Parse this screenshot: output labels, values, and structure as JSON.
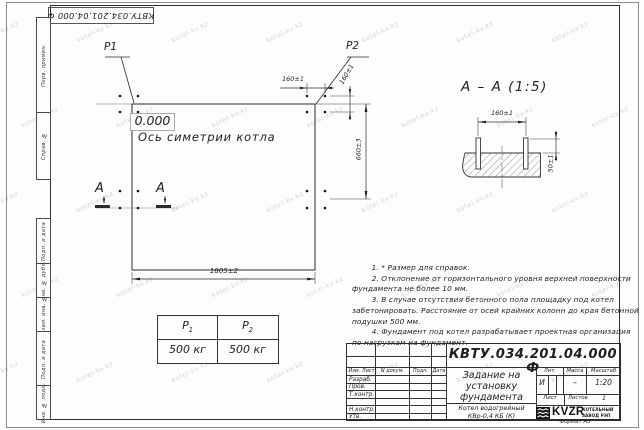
{
  "colors": {
    "ink": "#2a2a2a",
    "paper": "#fdfdfc",
    "watermark": "#9aa6b0"
  },
  "watermark": {
    "text": "kotel-kv.kz"
  },
  "frame": {
    "top_designation": "КВТУ.034.201.04.000 Ф",
    "side_labels": [
      "Перв. примен.",
      "Справ. №",
      "Подп. и дата",
      "Инв. № дубл.",
      "Взам. инв. №",
      "Подп. и дата",
      "Инв. № подл."
    ],
    "format_label": "Формат А3"
  },
  "plan": {
    "p1_label": "P1",
    "p2_label": "P2",
    "elevation": "0.000",
    "axis_label": "Ось симетрии котла",
    "dim_160_top": "160±1",
    "dim_160_side": "160±1",
    "dim_660": "660±3",
    "dim_1805": "1805±2",
    "section_letter_left": "А",
    "section_letter_right": "А"
  },
  "section_view": {
    "title": "А – А (1:5)",
    "dim_160": "160±1",
    "dim_50": "50±1"
  },
  "load_table": {
    "p1_base": "Р",
    "p1_sub": "1",
    "p2_base": "Р",
    "p2_sub": "2",
    "p1_value": "500 кг",
    "p2_value": "500 кг"
  },
  "notes": {
    "lines": [
      "        1. * Размер для справок.",
      "        2. Отклонение от горизонтального уровня верхней поверхности",
      "фундамента не более 10 мм.",
      "        3. В случае отсутствия бетонного пола площадку под котел",
      "забетонировать. Расстояние от осей крайних колонн до края бетонной",
      "подушки 500 мм.",
      "        4. Фундамент под котел разрабатывает проектная организация",
      "по нагрузкам на фундамент."
    ]
  },
  "title_block": {
    "designation": "КВТУ.034.201.04.000 Ф",
    "doc_title_line1": "Задание на",
    "doc_title_line2": "установку",
    "doc_title_line3": "фундамента",
    "product_line1": "Котел водогрейный",
    "product_line2": "КВр-0,4  КБ  (К)",
    "header_izm": "Изм. Лист",
    "header_ndoc": "N докум.",
    "header_podp": "Подп.",
    "header_data": "Дата",
    "row_labels": [
      "Разраб.",
      "Пров.",
      "Т.контр.",
      "Н.контр.",
      "Утв."
    ],
    "lit_header": "Лит.",
    "mass_header": "Масса",
    "scale_header": "Масштаб",
    "lit_value": "И",
    "mass_value": "–",
    "scale_value": "1:20",
    "sheet_label": "Лист",
    "sheets_label": "Листов",
    "sheets_value": "1",
    "logo_text": "KVZR",
    "logo_sub1": "КОТЕЛЬНЫЙ",
    "logo_sub2": "ЗАВОД РЭП"
  }
}
